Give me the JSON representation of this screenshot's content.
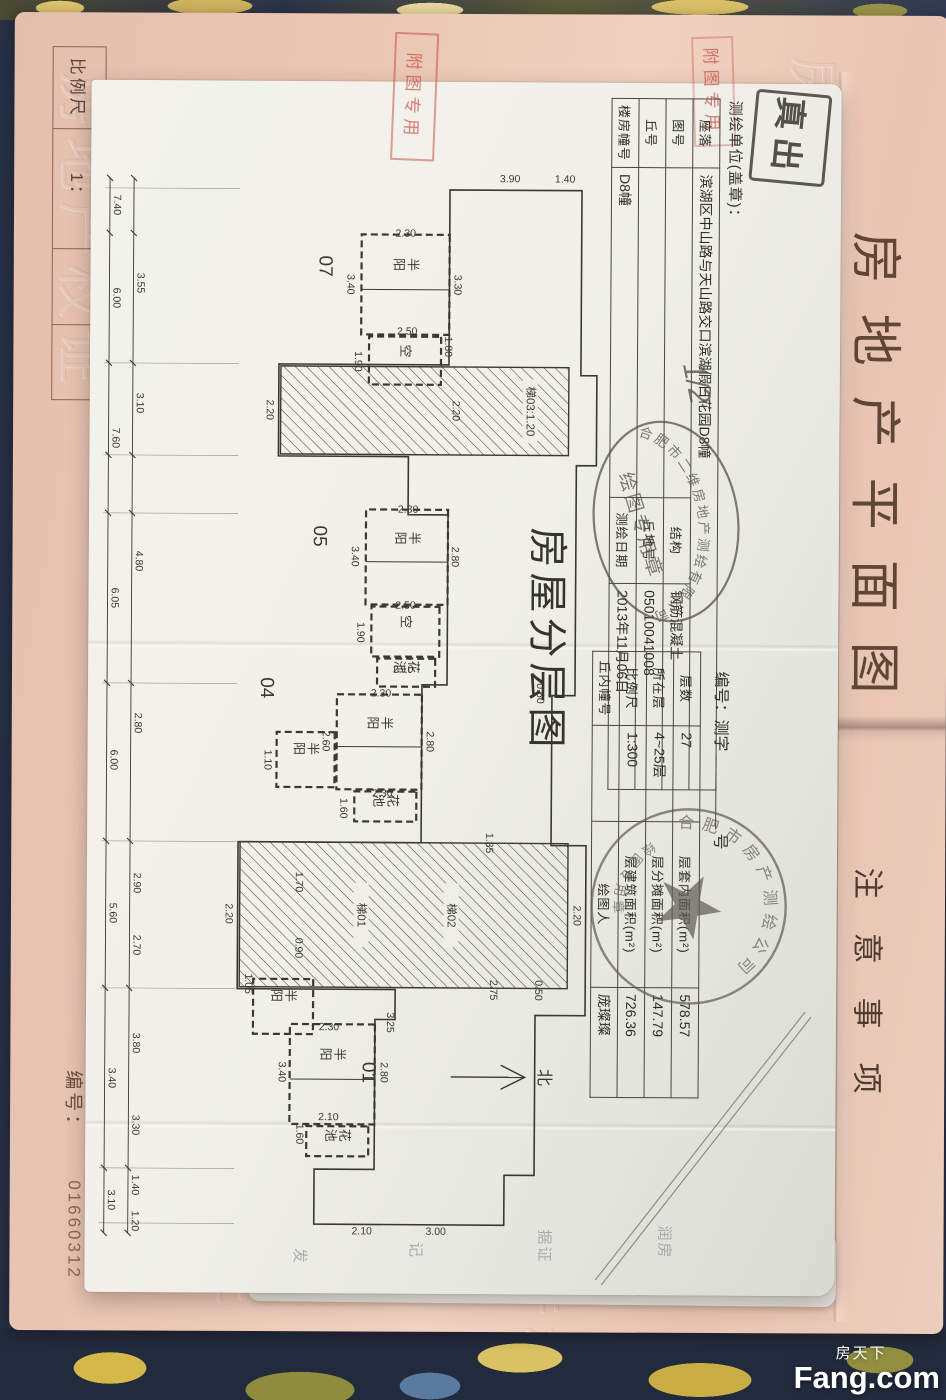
{
  "cover": {
    "title": "房地产平面图",
    "sheet_label": "图幅号：",
    "notes_title": "注意事项",
    "scale_label": "比例尺",
    "scale_value": "1：",
    "serial_label": "编号：",
    "serial_number": "01660312",
    "emboss_text": "房地产权证"
  },
  "watermark": {
    "cn": "房天下",
    "en": "Fang.com"
  },
  "page": {
    "surveyor_line": "测绘单位(盖章)：",
    "title": "房屋分层图",
    "number_prefix": "编号：测字",
    "number_suffix": "号",
    "handwritten": "1/2",
    "north_label": "北",
    "table_a": [
      [
        "座落",
        "滨湖区中山路与天山路交口滨湖假日花园D8幢",
        "",
        ""
      ],
      [
        "图号",
        "",
        "结构",
        "钢筋混凝土"
      ],
      [
        "丘号",
        "",
        "丘地号",
        "05010041008"
      ],
      [
        "楼房幢号",
        "D8幢",
        "测绘日期",
        "2013年11月06日"
      ]
    ],
    "table_c": [
      [
        "层数",
        "27",
        "层套内面积(m²)",
        "578.57"
      ],
      [
        "所在层",
        "4~25层",
        "层分摊面积(m²)",
        "147.79"
      ],
      [
        "比例尺",
        "1:300",
        "层建筑面积(m²)",
        "726.36"
      ],
      [
        "丘内幢号",
        "",
        "绘图人",
        "庞璨璨"
      ]
    ],
    "stamps": {
      "ellipse_ring": "合肥市二维房地产测绘有限公司",
      "ellipse_center": "绘图专用章",
      "round_ring": "合肥市房产测绘公司",
      "round_bottom": "绘图专用章",
      "black_text": "真出",
      "red_text": "附图专用"
    },
    "ghost_texts": [
      "发",
      "记",
      "据证",
      "润房"
    ]
  },
  "plan": {
    "outline": "M105,258 L290,258 L290,242 L380,242 L380,262 L610,262 L610,285 L760,285 L760,250 L930,250 L930,300 L1090,300 L1090,330 L1140,330 L1140,520 L1085,520 L1085,460 L935,460 L935,440 L905,440 L905,598 L758,598 L758,415 L600,415 L600,390 L430,390 L430,430 L372,430 L372,560 L280,560 L280,390 L105,390 Z",
    "chain1_y": 730,
    "chain2_y": 706,
    "chain_x0": 95,
    "chain_x1": 1150,
    "ticks": [
      95,
      150,
      280,
      372,
      430,
      600,
      758,
      905,
      1085,
      1150
    ],
    "extensions": [
      105,
      280,
      372,
      430,
      600,
      758,
      905,
      1085,
      1140
    ],
    "diagonal": [
      [
        925,
        30,
        1194,
        238
      ],
      [
        930,
        24,
        1199,
        232
      ]
    ],
    "north": {
      "x": 992,
      "y1": 384,
      "y2": 310,
      "label_y": 296
    },
    "units": [
      {
        "x": 182,
        "y": 520,
        "t": "07"
      },
      {
        "x": 452,
        "y": 524,
        "t": "05"
      },
      {
        "x": 604,
        "y": 576,
        "t": "04"
      },
      {
        "x": 988,
        "y": 472,
        "t": "01"
      }
    ],
    "rooms": [
      {
        "x": 150,
        "y": 390,
        "w": 100,
        "h": 88,
        "label": "半阳",
        "div": true
      },
      {
        "x": 252,
        "y": 398,
        "w": 48,
        "h": 72,
        "label": "空"
      },
      {
        "x": 425,
        "y": 390,
        "w": 95,
        "h": 82,
        "label": "半阳",
        "div": true
      },
      {
        "x": 522,
        "y": 398,
        "w": 50,
        "h": 68,
        "label": "空"
      },
      {
        "x": 574,
        "y": 402,
        "w": 28,
        "h": 58,
        "label": "花池"
      },
      {
        "x": 610,
        "y": 415,
        "w": 95,
        "h": 85,
        "label": "半阳",
        "div": true
      },
      {
        "x": 707,
        "y": 420,
        "w": 30,
        "h": 62,
        "label": "花池"
      },
      {
        "x": 648,
        "y": 502,
        "w": 55,
        "h": 58,
        "label": "半阳"
      },
      {
        "x": 940,
        "y": 460,
        "w": 100,
        "h": 85,
        "label": "半阳",
        "div": true
      },
      {
        "x": 1042,
        "y": 466,
        "w": 30,
        "h": 62,
        "label": "花池"
      },
      {
        "x": 895,
        "y": 522,
        "w": 55,
        "h": 60,
        "label": "半阳"
      }
    ],
    "cores": [
      {
        "x": 282,
        "y": 270,
        "w": 88,
        "h": 288,
        "labels": [
          {
            "t": "梯03:1.20",
            "y": 312
          }
        ]
      },
      {
        "x": 758,
        "y": 268,
        "w": 145,
        "h": 328,
        "labels": [
          {
            "t": "梯02",
            "y": 388
          },
          {
            "t": "梯01",
            "y": 478
          }
        ]
      }
    ],
    "dims": [
      {
        "x": 122,
        "y": 726,
        "t": "7.40"
      },
      {
        "x": 215,
        "y": 726,
        "t": "6.00"
      },
      {
        "x": 355,
        "y": 726,
        "t": "7.60"
      },
      {
        "x": 515,
        "y": 726,
        "t": "6.05"
      },
      {
        "x": 677,
        "y": 726,
        "t": "6.00"
      },
      {
        "x": 830,
        "y": 726,
        "t": "5.60"
      },
      {
        "x": 995,
        "y": 726,
        "t": "3.40"
      },
      {
        "x": 1117,
        "y": 726,
        "t": "3.10"
      },
      {
        "x": 200,
        "y": 702,
        "t": "3.55"
      },
      {
        "x": 320,
        "y": 702,
        "t": "3.10"
      },
      {
        "x": 478,
        "y": 702,
        "t": "4.80"
      },
      {
        "x": 640,
        "y": 702,
        "t": "2.80"
      },
      {
        "x": 800,
        "y": 702,
        "t": "2.90"
      },
      {
        "x": 862,
        "y": 702,
        "t": "2.70"
      },
      {
        "x": 960,
        "y": 702,
        "t": "3.80"
      },
      {
        "x": 1042,
        "y": 702,
        "t": "3.30"
      },
      {
        "x": 1102,
        "y": 702,
        "t": "1.40"
      },
      {
        "x": 1138,
        "y": 702,
        "t": "1.20"
      },
      {
        "x": 97,
        "y": 330,
        "t": "3.90",
        "r": -90
      },
      {
        "x": 97,
        "y": 275,
        "t": "1.40",
        "r": -90
      },
      {
        "x": 1150,
        "y": 398,
        "t": "3.00",
        "r": -90
      },
      {
        "x": 1150,
        "y": 472,
        "t": "2.10",
        "r": -90
      },
      {
        "x": 200,
        "y": 385,
        "t": "3.30"
      },
      {
        "x": 200,
        "y": 492,
        "t": "3.40"
      },
      {
        "x": 152,
        "y": 434,
        "t": "2.30",
        "r": -90
      },
      {
        "x": 250,
        "y": 432,
        "t": "2.50",
        "r": -90
      },
      {
        "x": 277,
        "y": 484,
        "t": "1.90"
      },
      {
        "x": 262,
        "y": 394,
        "t": "1.80"
      },
      {
        "x": 326,
        "y": 386,
        "t": "2.20"
      },
      {
        "x": 326,
        "y": 572,
        "t": "2.20"
      },
      {
        "x": 472,
        "y": 386,
        "t": "2.80"
      },
      {
        "x": 472,
        "y": 486,
        "t": "3.40"
      },
      {
        "x": 428,
        "y": 430,
        "t": "2.30",
        "r": -90
      },
      {
        "x": 524,
        "y": 432,
        "t": "2.50",
        "r": -90
      },
      {
        "x": 548,
        "y": 480,
        "t": "1.90"
      },
      {
        "x": 588,
        "y": 434,
        "t": "2.10",
        "r": -90
      },
      {
        "x": 657,
        "y": 410,
        "t": "2.80"
      },
      {
        "x": 657,
        "y": 514,
        "t": "2.60"
      },
      {
        "x": 612,
        "y": 456,
        "t": "2.30",
        "r": -90
      },
      {
        "x": 712,
        "y": 454,
        "t": "2.30",
        "r": -90
      },
      {
        "x": 724,
        "y": 496,
        "t": "1.60"
      },
      {
        "x": 676,
        "y": 572,
        "t": "1.10"
      },
      {
        "x": 608,
        "y": 300,
        "t": "0.60"
      },
      {
        "x": 758,
        "y": 350,
        "t": "1.85"
      },
      {
        "x": 830,
        "y": 262,
        "t": "2.20"
      },
      {
        "x": 830,
        "y": 610,
        "t": "2.20"
      },
      {
        "x": 798,
        "y": 540,
        "t": "1.70"
      },
      {
        "x": 864,
        "y": 540,
        "t": "0.90"
      },
      {
        "x": 900,
        "y": 590,
        "t": "1.05"
      },
      {
        "x": 905,
        "y": 345,
        "t": "2.75"
      },
      {
        "x": 938,
        "y": 448,
        "t": "3.25"
      },
      {
        "x": 988,
        "y": 454,
        "t": "2.80"
      },
      {
        "x": 988,
        "y": 556,
        "t": "3.40"
      },
      {
        "x": 946,
        "y": 506,
        "t": "2.30",
        "r": -90
      },
      {
        "x": 1036,
        "y": 506,
        "t": "2.10",
        "r": -90
      },
      {
        "x": 1050,
        "y": 538,
        "t": "1.60"
      },
      {
        "x": 905,
        "y": 300,
        "t": "0.50"
      }
    ]
  }
}
